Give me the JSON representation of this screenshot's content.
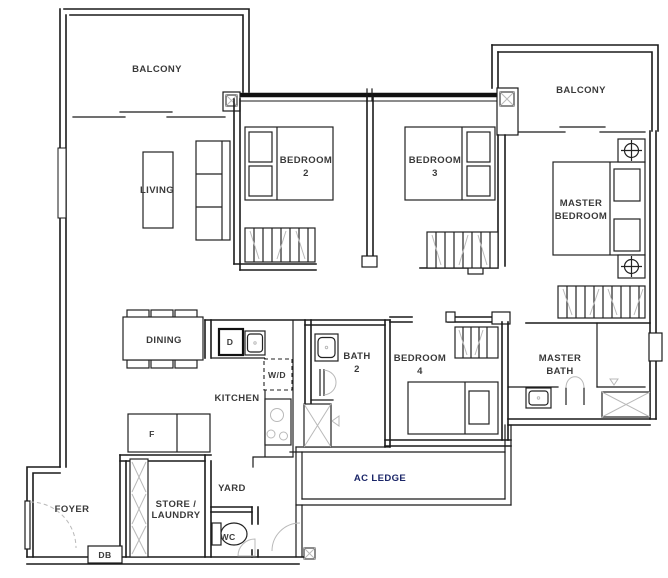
{
  "meta": {
    "drawing_type": "apartment floor plan"
  },
  "colors": {
    "background": "#ffffff",
    "wall": "#1a1a1a",
    "detail_gray": "#b9b9b9",
    "label": "#3a3a3a",
    "ac_ledge_label": "#1b2668"
  },
  "rooms": {
    "balcony_left": "BALCONY",
    "balcony_right": "BALCONY",
    "living": "LIVING",
    "bedroom2_line1": "BEDROOM",
    "bedroom2_line2": "2",
    "bedroom3_line1": "BEDROOM",
    "bedroom3_line2": "3",
    "master_bedroom_line1": "MASTER",
    "master_bedroom_line2": "BEDROOM",
    "dining": "DINING",
    "kitchen": "KITCHEN",
    "bath2_line1": "BATH",
    "bath2_line2": "2",
    "bedroom4_line1": "BEDROOM",
    "bedroom4_line2": "4",
    "master_bath_line1": "MASTER",
    "master_bath_line2": "BATH",
    "yard": "YARD",
    "store_laundry_line1": "STORE /",
    "store_laundry_line2": "LAUNDRY",
    "foyer": "FOYER",
    "wc": "WC",
    "ac_ledge": "AC LEDGE"
  },
  "appliances": {
    "dishwasher": "D",
    "washer_dryer": "W/D",
    "fridge": "F",
    "distribution_board": "DB"
  }
}
